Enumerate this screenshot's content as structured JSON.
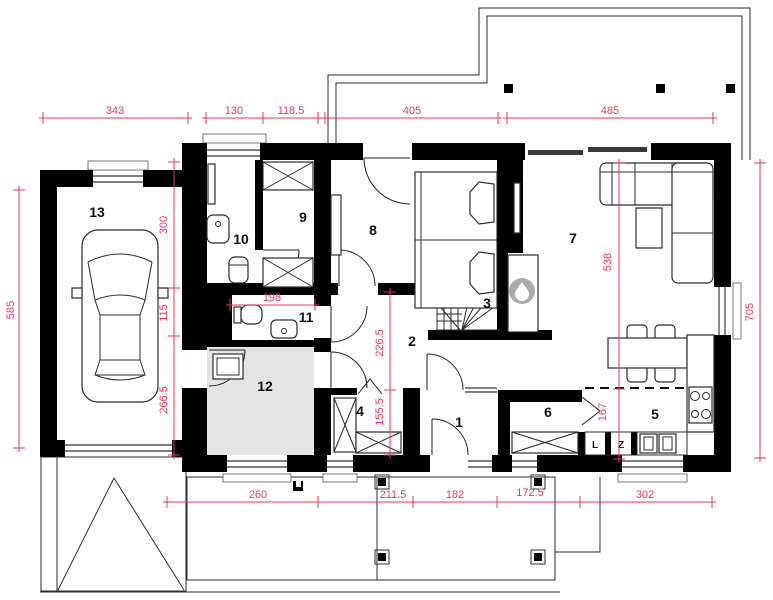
{
  "colors": {
    "dimension": "#E8365A",
    "wall": "#000000",
    "utility_floor": "#E4E4E4",
    "fireplace_gray": "#ABABAB"
  },
  "room_labels": {
    "r1": "1",
    "r2": "2",
    "r3": "3",
    "r4": "4",
    "r5": "5",
    "r6": "6",
    "r7": "7",
    "r8": "8",
    "r9": "9",
    "r10": "10",
    "r11": "11",
    "r12": "12",
    "r13": "13"
  },
  "dimensions": {
    "top": {
      "d1": "343",
      "d2": "130",
      "d3": "118.5",
      "d4": "405",
      "d5": "485"
    },
    "bottom": {
      "d1": "260",
      "d2": "211.5",
      "d3": "182",
      "d4": "172.5",
      "d5": "302"
    },
    "left": {
      "d1": "585"
    },
    "right": {
      "d1": "705"
    },
    "interior": {
      "v300": "300",
      "v115": "115",
      "v266": "266.5",
      "wc_width": "198",
      "v226": "226.5",
      "v155": "155.5",
      "v538": "538",
      "v167": "167"
    }
  },
  "kitchen": {
    "fridge": "L",
    "dishwasher": "Z"
  }
}
